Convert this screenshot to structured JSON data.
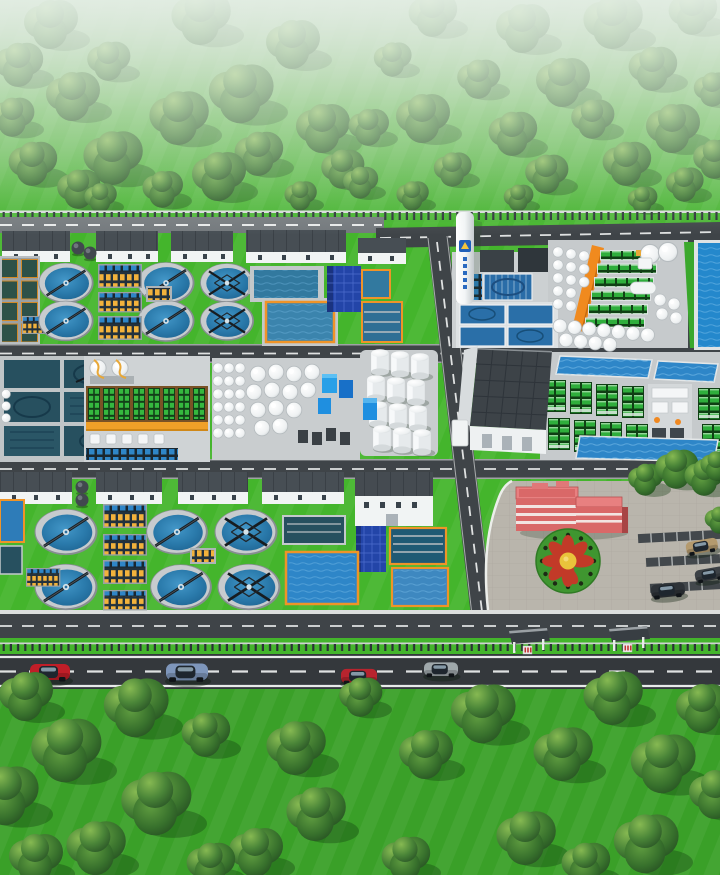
{
  "scene": {
    "description": "aerial 3d rendering of a wastewater treatment plant campus with clarifier tanks, storage tank farms, process buildings, roads, cars and tree fields",
    "style": "hazy top horizon, bright green lawns, isometric-like perspective",
    "palette": {
      "grass_main": "#44b52c",
      "grass_bottom": "#3aa028",
      "road_dark": "#3f4448",
      "road_main": "#34383c",
      "road_light": "#74797d",
      "road_line": "#e8eaea",
      "sidewalk": "#dcdfde",
      "pad_concrete": "#c6cacc",
      "building_wall": "#f1f4f4",
      "building_roof": "#474e54",
      "warehouse_roof": "#3d4348",
      "clarifier_rim": "#c7cbce",
      "clarifier_water": "#2a7aab",
      "water_blue": "#2e86c8",
      "basin_teal": "#27505f",
      "rim_orange": "#ef9428",
      "orange_strip": "#f08a1e",
      "walkway_orange": "#f0a028",
      "rack_yellow": "#f2b23c",
      "rack_green": "#35b83f",
      "navy_panel": "#2345a8",
      "tank_white": "#f4f6f7",
      "cube_blue": "#1f8fe0",
      "red_building": "#d96868",
      "red_building_side": "#a84444",
      "red_building_roof": "#e88080",
      "plaza": "#b9b5ac",
      "flower_ring": "#3f9630",
      "flower_red": "#c23a28",
      "flower_yellow": "#e9c43b",
      "fence": "#2a3136",
      "shelter": "#383e43",
      "tower_logo": "#1f5fb8"
    },
    "counts": {
      "clarifier_tanks": 12,
      "white_process_buildings": 10,
      "white_storage_tanks_estimate": 85,
      "green_filter_bed_rows": 6,
      "membrane_rack_units": 10,
      "bus_shelters": 2,
      "road_cars": 4,
      "parking_cars": 3,
      "trees_top_field": 42,
      "trees_bottom_field": 24,
      "plaza_trees": 5
    },
    "road_cars": [
      {
        "color_name": "red",
        "hex": "#c01e28"
      },
      {
        "color_name": "steel-blue",
        "hex": "#7e96bb"
      },
      {
        "color_name": "red",
        "hex": "#b8242e"
      },
      {
        "color_name": "silver",
        "hex": "#9fa8ab"
      }
    ],
    "parking_cars": [
      {
        "color_name": "tan",
        "hex": "#b49a6e"
      },
      {
        "color_name": "black",
        "hex": "#2e3338"
      },
      {
        "color_name": "dark-gray",
        "hex": "#3c4146"
      }
    ]
  }
}
